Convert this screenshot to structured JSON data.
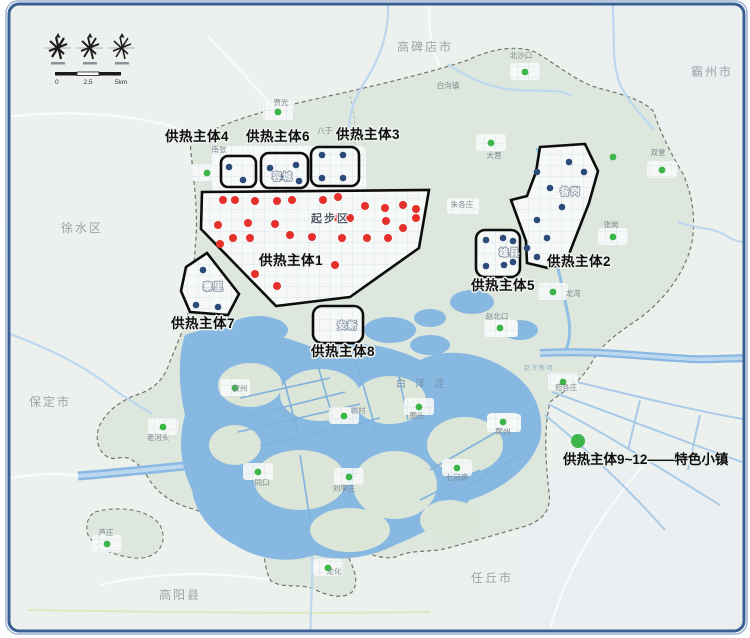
{
  "neighbor_regions": [
    {
      "name": "高碑店市",
      "x": 425,
      "y": 51
    },
    {
      "name": "霸州市",
      "x": 712,
      "y": 76
    },
    {
      "name": "徐水区",
      "x": 82,
      "y": 232
    },
    {
      "name": "保定市",
      "x": 50,
      "y": 406
    },
    {
      "name": "高阳县",
      "x": 180,
      "y": 599
    },
    {
      "name": "任丘市",
      "x": 492,
      "y": 582
    }
  ],
  "districts": [
    {
      "name": "起步区",
      "x": 311,
      "y": 222,
      "style": "district",
      "ls": 2
    },
    {
      "name": "容城",
      "x": 272,
      "y": 180,
      "style": "district-sm",
      "ls": 32
    },
    {
      "name": "雄县",
      "x": 499,
      "y": 256,
      "style": "district-sm",
      "ls": 4
    },
    {
      "name": "昝岗",
      "x": 560,
      "y": 195,
      "style": "district-sm",
      "ls": 4
    },
    {
      "name": "安新",
      "x": 337,
      "y": 329,
      "style": "district-sm",
      "ls": 4
    },
    {
      "name": "寨里",
      "x": 203,
      "y": 290,
      "style": "district-sm",
      "ls": 4
    }
  ],
  "water_labels": [
    {
      "name": "白洋淀",
      "x": 396,
      "y": 387,
      "style": "water"
    },
    {
      "name": "赵王新河",
      "x": 524,
      "y": 370,
      "style": "river"
    }
  ],
  "zones": [
    {
      "id": "1",
      "label": "供热主体1",
      "x": 291,
      "y": 265
    },
    {
      "id": "2",
      "label": "供热主体2",
      "x": 579,
      "y": 266
    },
    {
      "id": "3",
      "label": "供热主体3",
      "x": 368,
      "y": 139
    },
    {
      "id": "4",
      "label": "供热主体4",
      "x": 197,
      "y": 141
    },
    {
      "id": "5",
      "label": "供热主体5",
      "x": 503,
      "y": 290
    },
    {
      "id": "6",
      "label": "供热主体6",
      "x": 278,
      "y": 141
    },
    {
      "id": "7",
      "label": "供热主体7",
      "x": 203,
      "y": 328
    },
    {
      "id": "8",
      "label": "供热主体8",
      "x": 343,
      "y": 356
    }
  ],
  "legend": {
    "label": "供热主体9~12——特色小镇",
    "x": 563,
    "y": 464,
    "dot": [
      578,
      441
    ],
    "dot_r": 7
  },
  "towns": [
    {
      "name": "北沙口",
      "x": 521,
      "y": 58,
      "dot": [
        525,
        72
      ]
    },
    {
      "name": "白沟镇",
      "x": 448,
      "y": 88,
      "dot": null
    },
    {
      "name": "贾光",
      "x": 281,
      "y": 105,
      "dot": [
        278,
        112
      ]
    },
    {
      "name": "八于",
      "x": 325,
      "y": 133,
      "dot": null
    },
    {
      "name": "南张",
      "x": 219,
      "y": 152,
      "dot": [
        207,
        173
      ]
    },
    {
      "name": "大营",
      "x": 494,
      "y": 158,
      "dot": [
        491,
        143
      ]
    },
    {
      "name": "双堂",
      "x": 658,
      "y": 155,
      "dot": [
        662,
        170
      ]
    },
    {
      "name": "朱各庄",
      "x": 462,
      "y": 207,
      "dot": null
    },
    {
      "name": "张岗",
      "x": 611,
      "y": 227,
      "dot": [
        613,
        237
      ]
    },
    {
      "name": "龙湾",
      "x": 573,
      "y": 296,
      "dot": [
        553,
        292
      ]
    },
    {
      "name": "赵北口",
      "x": 497,
      "y": 319,
      "dot": [
        500,
        328
      ]
    },
    {
      "name": "苟各庄",
      "x": 566,
      "y": 390,
      "dot": [
        563,
        382
      ]
    },
    {
      "name": "鄚州",
      "x": 503,
      "y": 434,
      "dot": [
        503,
        422
      ]
    },
    {
      "name": "圈头",
      "x": 417,
      "y": 418,
      "dot": [
        419,
        407
      ]
    },
    {
      "name": "七间房",
      "x": 457,
      "y": 480,
      "dot": [
        457,
        468
      ]
    },
    {
      "name": "安州",
      "x": 240,
      "y": 391,
      "dot": [
        235,
        388
      ]
    },
    {
      "name": "老河头",
      "x": 158,
      "y": 440,
      "dot": [
        163,
        427
      ]
    },
    {
      "name": "同口",
      "x": 262,
      "y": 485,
      "dot": [
        258,
        472
      ]
    },
    {
      "name": "端村",
      "x": 358,
      "y": 413,
      "dot": [
        344,
        416
      ]
    },
    {
      "name": "刘李庄",
      "x": 344,
      "y": 491,
      "dot": [
        349,
        477
      ]
    },
    {
      "name": "龙化",
      "x": 334,
      "y": 574,
      "dot": [
        328,
        568
      ]
    },
    {
      "name": "芦庄",
      "x": 106,
      "y": 535,
      "dot": [
        107,
        544
      ]
    }
  ],
  "extra_green_dots": [
    [
      613,
      157
    ]
  ],
  "dots": {
    "red": [
      [
        223,
        200
      ],
      [
        235,
        200
      ],
      [
        255,
        201
      ],
      [
        277,
        201
      ],
      [
        292,
        200
      ],
      [
        323,
        200
      ],
      [
        338,
        197
      ],
      [
        365,
        206
      ],
      [
        385,
        208
      ],
      [
        403,
        205
      ],
      [
        416,
        209
      ],
      [
        218,
        225
      ],
      [
        248,
        223
      ],
      [
        275,
        224
      ],
      [
        338,
        218
      ],
      [
        350,
        218
      ],
      [
        386,
        221
      ],
      [
        403,
        228
      ],
      [
        416,
        218
      ],
      [
        220,
        244
      ],
      [
        233,
        238
      ],
      [
        250,
        238
      ],
      [
        290,
        235
      ],
      [
        312,
        237
      ],
      [
        342,
        238
      ],
      [
        367,
        238
      ],
      [
        388,
        238
      ],
      [
        335,
        265
      ],
      [
        255,
        274
      ],
      [
        277,
        286
      ]
    ],
    "blue": [
      [
        229,
        167
      ],
      [
        243,
        180
      ],
      [
        270,
        168
      ],
      [
        296,
        165
      ],
      [
        281,
        177
      ],
      [
        299,
        181
      ],
      [
        322,
        155
      ],
      [
        343,
        155
      ],
      [
        322,
        178
      ],
      [
        343,
        178
      ],
      [
        486,
        240
      ],
      [
        503,
        238
      ],
      [
        513,
        241
      ],
      [
        486,
        266
      ],
      [
        504,
        265
      ],
      [
        513,
        262
      ],
      [
        203,
        270
      ],
      [
        196,
        305
      ],
      [
        218,
        307
      ],
      [
        537,
        172
      ],
      [
        569,
        162
      ],
      [
        584,
        172
      ],
      [
        550,
        188
      ],
      [
        562,
        207
      ],
      [
        537,
        220
      ],
      [
        547,
        238
      ],
      [
        527,
        248
      ],
      [
        537,
        257
      ]
    ]
  },
  "scale_bar": {
    "labels": [
      "0",
      "2.5",
      "5km"
    ]
  },
  "colors": {
    "red": "#e6302b",
    "blue": "#2c4b78",
    "green": "#3eb54b",
    "water": "#87b8e2",
    "border": "#3a5f93",
    "zone_outline": "#0d0d0d"
  }
}
